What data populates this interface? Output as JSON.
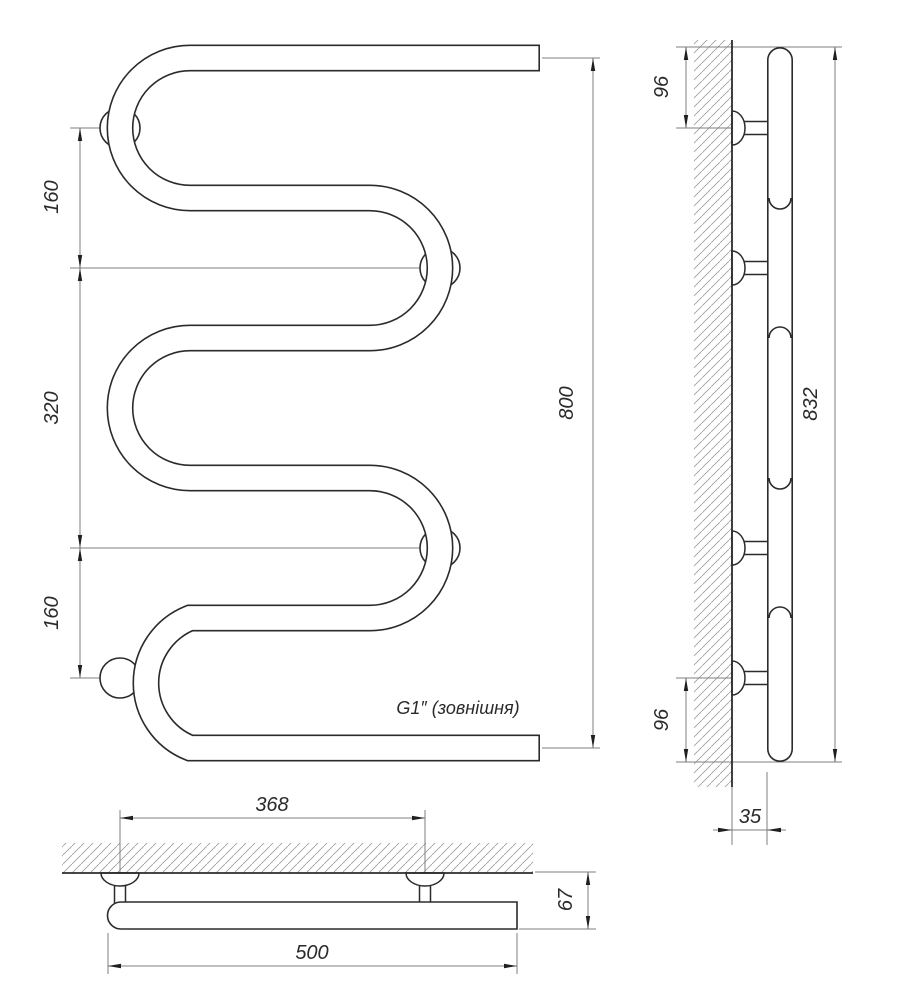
{
  "front_view": {
    "dim_spacing_top": "160",
    "dim_spacing_middle": "320",
    "dim_spacing_bottom": "160",
    "dim_height": "800",
    "thread_label": "G1″ (зовнішня)"
  },
  "side_view": {
    "dim_bracket_top": "96",
    "dim_overall_height": "832",
    "dim_bracket_bottom": "96",
    "dim_wall_offset": "35"
  },
  "plan_view": {
    "dim_bracket_spacing": "368",
    "dim_width": "500",
    "dim_depth": "67"
  },
  "colors": {
    "line": "#2b2b2b",
    "dim_line": "#7f7f7f",
    "background": "#ffffff"
  }
}
